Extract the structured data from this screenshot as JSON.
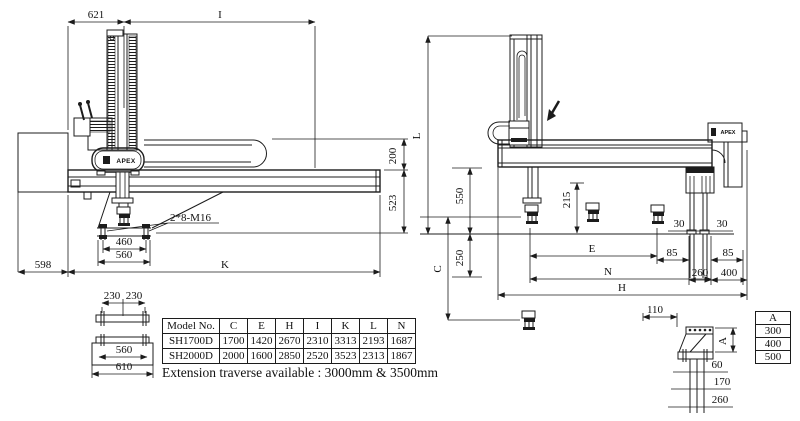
{
  "brand": {
    "logo": "APEX"
  },
  "left_view": {
    "dims": {
      "top_left": "621",
      "top_right": "I",
      "right_upper": "200",
      "right_lower": "523",
      "bottom_left": "598",
      "bottom_main": "K",
      "plate_inner": "460",
      "plate_outer": "560",
      "bolt_callout": "2*8-M16"
    }
  },
  "right_view": {
    "dims": {
      "total_height": "L",
      "beam_to_floor": "550",
      "mid_stroke": "215",
      "below_floor": "250",
      "vertical_stroke": "C",
      "span_e": "E",
      "span_n": "N",
      "span_h": "H",
      "leg_offset_left": "30",
      "leg_offset_right": "30",
      "pad_left": "85",
      "pad_right": "85",
      "leg_width": "260",
      "tail": "400"
    }
  },
  "base_detail": {
    "dims": {
      "half_left": "230",
      "half_right": "230",
      "inner": "560",
      "outer": "610"
    }
  },
  "bracket_detail": {
    "dims": {
      "offset": "110",
      "var_height": "A",
      "depth1": "60",
      "depth2": "170",
      "depth3": "260"
    }
  },
  "spec_table": {
    "headers": [
      "Model No.",
      "C",
      "E",
      "H",
      "I",
      "K",
      "L",
      "N"
    ],
    "rows": [
      [
        "SH1700D",
        "1700",
        "1420",
        "2670",
        "2310",
        "3313",
        "2193",
        "1687"
      ],
      [
        "SH2000D",
        "2000",
        "1600",
        "2850",
        "2520",
        "3523",
        "2313",
        "1867"
      ]
    ]
  },
  "a_table": {
    "header": "A",
    "values": [
      "300",
      "400",
      "500"
    ]
  },
  "note": "Extension traverse available : 3000mm & 3500mm"
}
